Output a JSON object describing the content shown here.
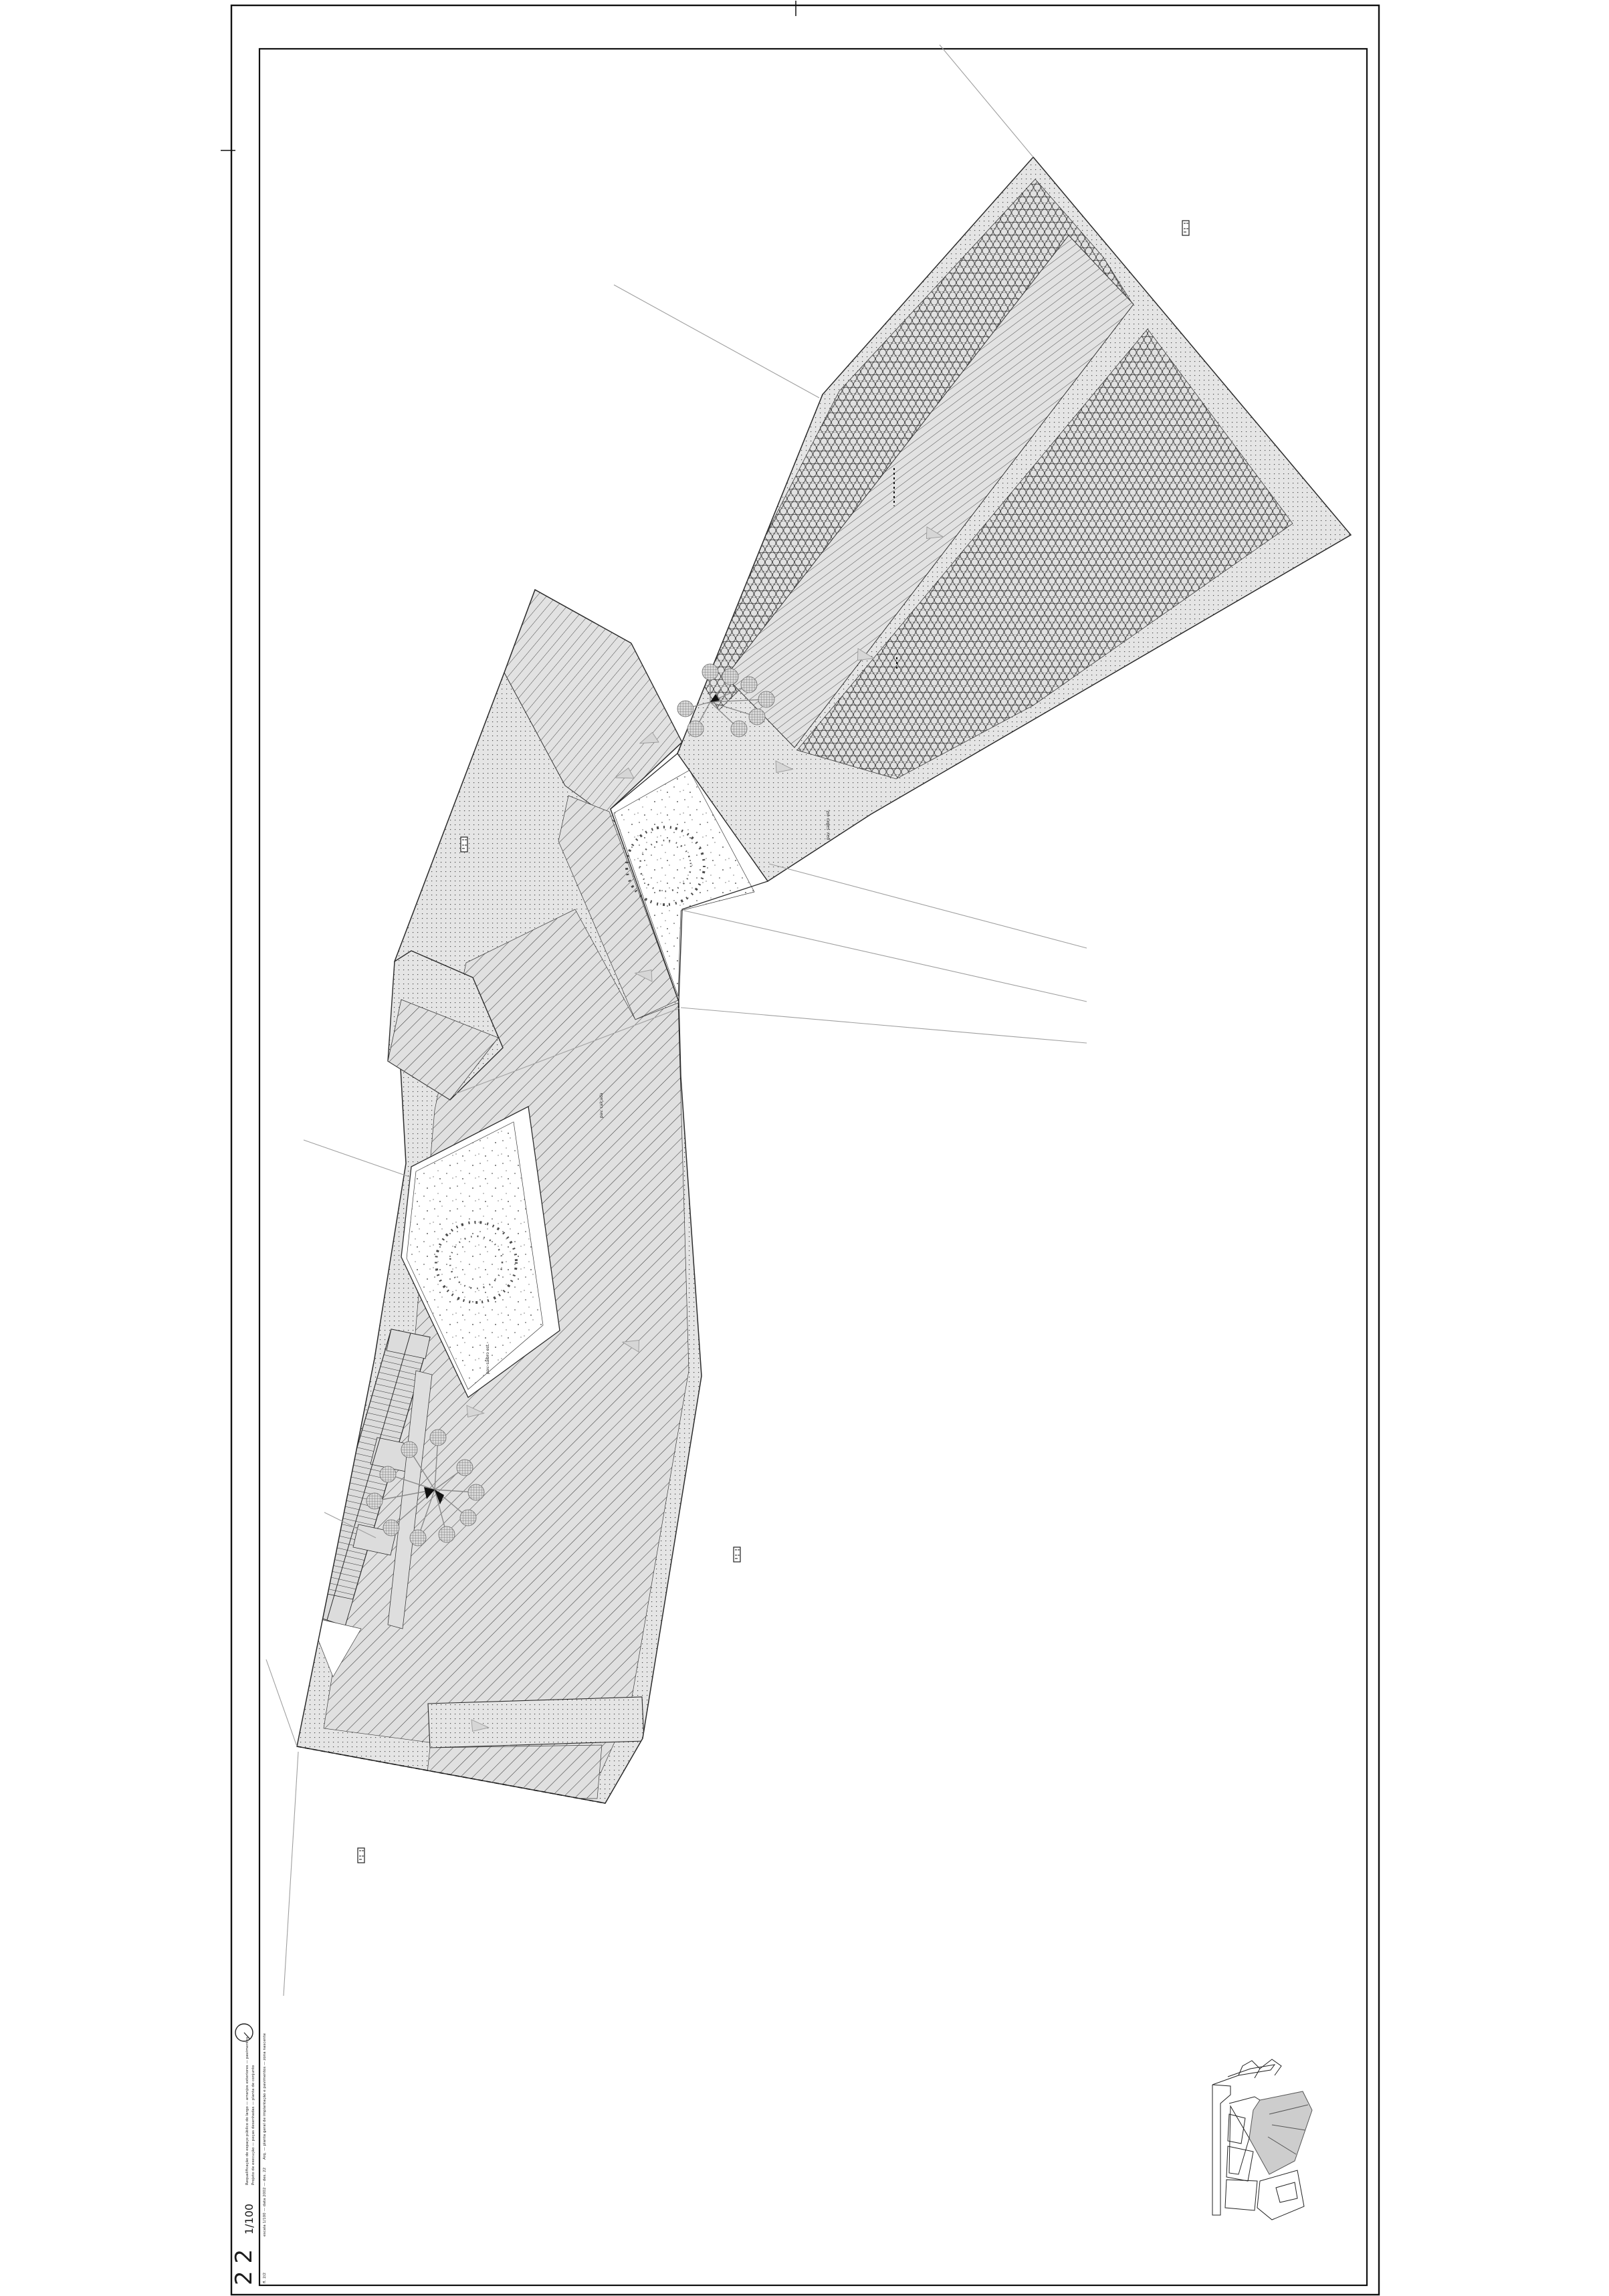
{
  "sheet": {
    "scale": "1/100",
    "number": "2 2",
    "titleblock": {
      "margin_line_1": "Requalificação do espaço público do largo — arranjos exteriores — pavimentos",
      "margin_line_2": "Projeto de execução — peças desenhadas — planta de conjunto",
      "inner_line_1": "Arq. — planta geral de implantação e pavimentos — zona nascente",
      "inner_line_2": "escala 1/100 — data 2002 — des. 22",
      "inner_line_3": "fl. 2/2"
    }
  },
  "plan": {
    "annotations": {
      "court1": "pav. saibro est.",
      "court2": "pav. saibro est.",
      "hatch": "pav. calçada"
    }
  },
  "icons": {
    "north": "north-arrow-icon",
    "tags": "annotation-tag"
  },
  "colors": {
    "paper": "#ffffff",
    "line": "#2a2a2a",
    "fill_light": "#e4e4e4",
    "fill_mid": "#dcdcdc",
    "keymap_site": "#cdcdcd"
  }
}
